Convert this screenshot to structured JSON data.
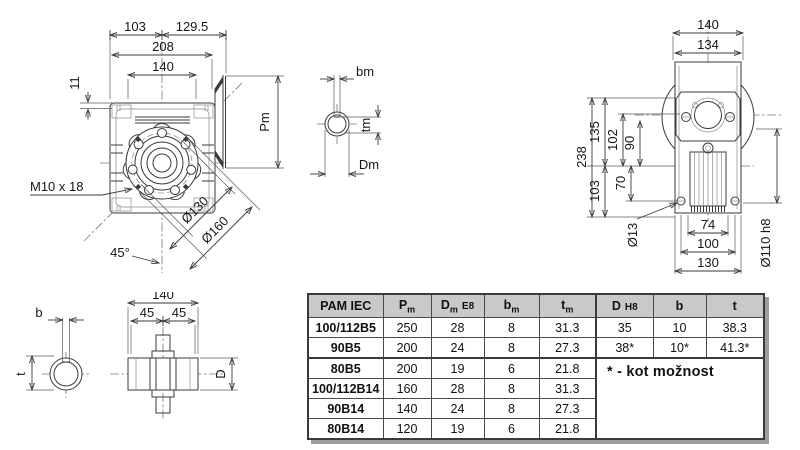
{
  "front_view": {
    "dim_103": "103",
    "dim_129_5": "129.5",
    "dim_208": "208",
    "dim_140": "140",
    "dim_11": "11",
    "thread_label": "M10 x 18",
    "angle_label": "45°",
    "dim_d130": "Ø130",
    "dim_d160": "Ø160",
    "dim_pm": "Pm"
  },
  "motor_shaft_section": {
    "dim_bm": "bm",
    "dim_tm": "tm",
    "dim_dm": "Dm"
  },
  "side_view": {
    "dim_140": "140",
    "dim_134": "134",
    "dim_238": "238",
    "dim_135": "135",
    "dim_102": "102",
    "dim_90": "90",
    "dim_103": "103",
    "dim_70": "70",
    "dim_d13": "Ø13",
    "dim_74": "74",
    "dim_100": "100",
    "dim_130": "130",
    "dim_d110": "Ø110 h8"
  },
  "hollow_shaft_view": {
    "dim_b": "b",
    "dim_t": "t",
    "dim_140": "140",
    "dim_45_left": "45",
    "dim_45_right": "45",
    "dim_d": "D"
  },
  "table": {
    "headers": {
      "pam_iec": "PAM IEC",
      "pm_main": "P",
      "pm_sub": "m",
      "dm_main": "D",
      "dm_sub": "m",
      "dm_suffix": "E8",
      "bm_main": "b",
      "bm_sub": "m",
      "tm_main": "t",
      "tm_sub": "m",
      "d_main": "D",
      "d_suffix": "H8",
      "b": "b",
      "t": "t"
    },
    "rows": [
      {
        "name": "100/112B5",
        "pm": "250",
        "dm": "28",
        "bm": "8",
        "tm": "31.3",
        "d": "35",
        "b": "10",
        "t": "38.3"
      },
      {
        "name": "90B5",
        "pm": "200",
        "dm": "24",
        "bm": "8",
        "tm": "27.3",
        "d": "38*",
        "b": "10*",
        "t": "41.3*"
      },
      {
        "name": "80B5",
        "pm": "200",
        "dm": "19",
        "bm": "6",
        "tm": "21.8"
      },
      {
        "name": "100/112B14",
        "pm": "160",
        "dm": "28",
        "bm": "8",
        "tm": "31.3"
      },
      {
        "name": "90B14",
        "pm": "140",
        "dm": "24",
        "bm": "8",
        "tm": "27.3"
      },
      {
        "name": "80B14",
        "pm": "120",
        "dm": "19",
        "bm": "6",
        "tm": "21.8"
      }
    ],
    "note": "* - kot možnost"
  },
  "colors": {
    "background": "#ffffff",
    "line": "#3a3a3a",
    "table_header_bg": "#c9c9c9",
    "table_border": "#3a3a3a",
    "table_shadow": "#9e9e9e"
  }
}
